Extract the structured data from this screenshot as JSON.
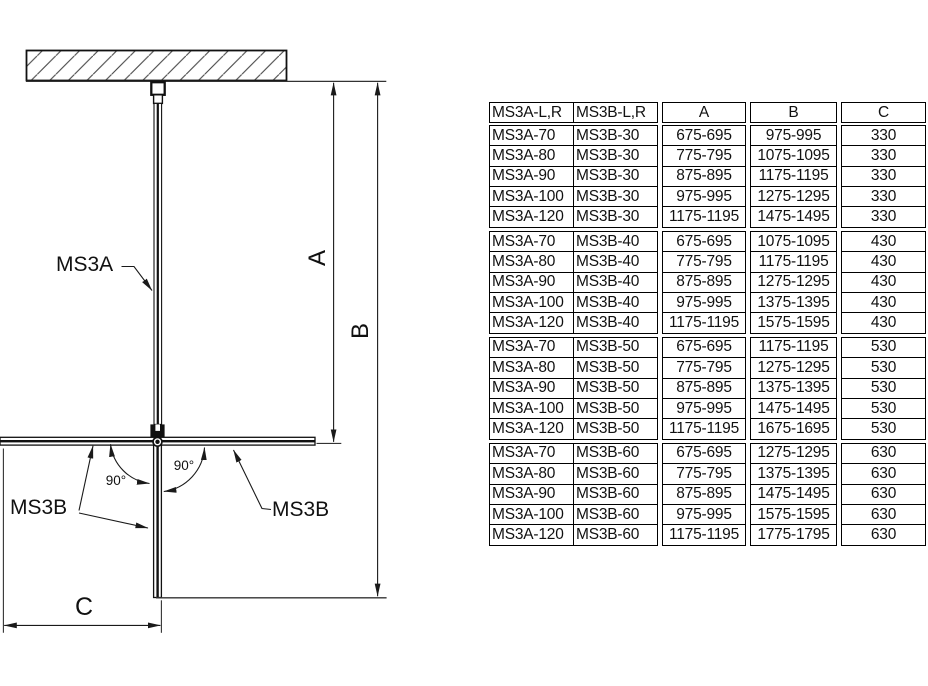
{
  "diagram": {
    "panel_top_label": "MS3A",
    "panel_left_label": "MS3B",
    "panel_right_label": "MS3B",
    "dim_a_label": "A",
    "dim_b_label": "B",
    "dim_c_label": "C",
    "angle_left": "90°",
    "angle_right": "90°"
  },
  "table": {
    "header": {
      "col1": "MS3A-L,R",
      "col2": "MS3B-L,R",
      "a": "A",
      "b": "B",
      "c": "C"
    },
    "groups": [
      {
        "rows": [
          [
            "MS3A-70",
            "MS3B-30",
            "675-695",
            "975-995",
            "330"
          ],
          [
            "MS3A-80",
            "MS3B-30",
            "775-795",
            "1075-1095",
            "330"
          ],
          [
            "MS3A-90",
            "MS3B-30",
            "875-895",
            "1175-1195",
            "330"
          ],
          [
            "MS3A-100",
            "MS3B-30",
            "975-995",
            "1275-1295",
            "330"
          ],
          [
            "MS3A-120",
            "MS3B-30",
            "1175-1195",
            "1475-1495",
            "330"
          ]
        ]
      },
      {
        "rows": [
          [
            "MS3A-70",
            "MS3B-40",
            "675-695",
            "1075-1095",
            "430"
          ],
          [
            "MS3A-80",
            "MS3B-40",
            "775-795",
            "1175-1195",
            "430"
          ],
          [
            "MS3A-90",
            "MS3B-40",
            "875-895",
            "1275-1295",
            "430"
          ],
          [
            "MS3A-100",
            "MS3B-40",
            "975-995",
            "1375-1395",
            "430"
          ],
          [
            "MS3A-120",
            "MS3B-40",
            "1175-1195",
            "1575-1595",
            "430"
          ]
        ]
      },
      {
        "rows": [
          [
            "MS3A-70",
            "MS3B-50",
            "675-695",
            "1175-1195",
            "530"
          ],
          [
            "MS3A-80",
            "MS3B-50",
            "775-795",
            "1275-1295",
            "530"
          ],
          [
            "MS3A-90",
            "MS3B-50",
            "875-895",
            "1375-1395",
            "530"
          ],
          [
            "MS3A-100",
            "MS3B-50",
            "975-995",
            "1475-1495",
            "530"
          ],
          [
            "MS3A-120",
            "MS3B-50",
            "1175-1195",
            "1675-1695",
            "530"
          ]
        ]
      },
      {
        "rows": [
          [
            "MS3A-70",
            "MS3B-60",
            "675-695",
            "1275-1295",
            "630"
          ],
          [
            "MS3A-80",
            "MS3B-60",
            "775-795",
            "1375-1395",
            "630"
          ],
          [
            "MS3A-90",
            "MS3B-60",
            "875-895",
            "1475-1495",
            "630"
          ],
          [
            "MS3A-100",
            "MS3B-60",
            "975-995",
            "1575-1595",
            "630"
          ],
          [
            "MS3A-120",
            "MS3B-60",
            "1175-1195",
            "1775-1795",
            "630"
          ]
        ]
      }
    ]
  }
}
